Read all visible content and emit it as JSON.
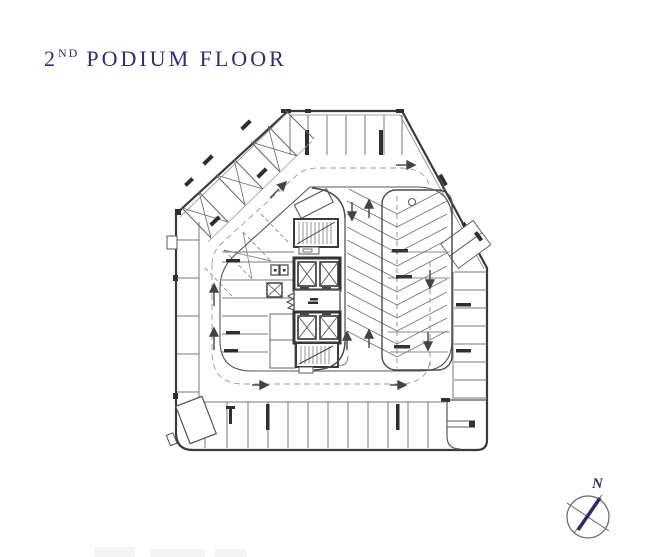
{
  "page": {
    "background": "#ffffff"
  },
  "title": {
    "number": "2",
    "ordinal": "ND",
    "text": "PODIUM FLOOR",
    "color": "#322d70"
  },
  "compass": {
    "label": "N",
    "color": "#2e2a6e"
  },
  "drawing": {
    "outline_color": "#3a3a3a",
    "stall_line_color": "#777777",
    "dashed_line_color": "#999999",
    "dark_fill_color": "#2f2f2f",
    "core_wall_color": "#333333"
  }
}
